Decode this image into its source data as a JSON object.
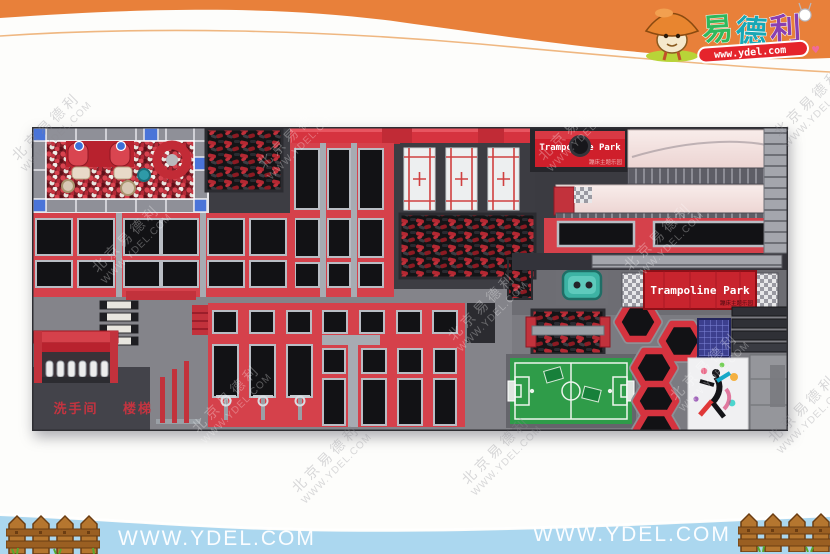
{
  "brand": {
    "chars": [
      "易",
      "德",
      "利"
    ],
    "url": "www.ydel.com",
    "char_colors": [
      "#2fb85c",
      "#18a7b5",
      "#8a3fb0"
    ],
    "ribbon_color": "#e5242c"
  },
  "park": {
    "top_sign": {
      "title": "Trampoline Park",
      "subtitle": "蹦床主题乐园"
    },
    "banner": {
      "title": "Trampoline Park",
      "subtitle": "蹦床主题乐园"
    },
    "labels": {
      "restroom": "洗手间",
      "stairs": "楼梯"
    },
    "colors": {
      "floor_dark": "#46464c",
      "walkway_gray": "#84848a",
      "deck_red": "#d5414b",
      "banner_red": "#c8242e",
      "trampoline_black": "#121215",
      "frame_silver": "#b9bdc4",
      "foam_red": "#b42832",
      "corner_blue": "#4a74d8",
      "field_green": "#2f9c49",
      "track_pink": "#f3e3e1",
      "device_teal": "#3db3a4"
    }
  },
  "watermark": {
    "cn": "北京易德利",
    "en": "WWW.YDEL.COM"
  },
  "header": {
    "band_color": "#e8803a"
  },
  "footer": {
    "band_color": "#abd7ef",
    "url_left": "WWW.YDEL.COM",
    "url_right": "WWW.YDEL.COM"
  }
}
